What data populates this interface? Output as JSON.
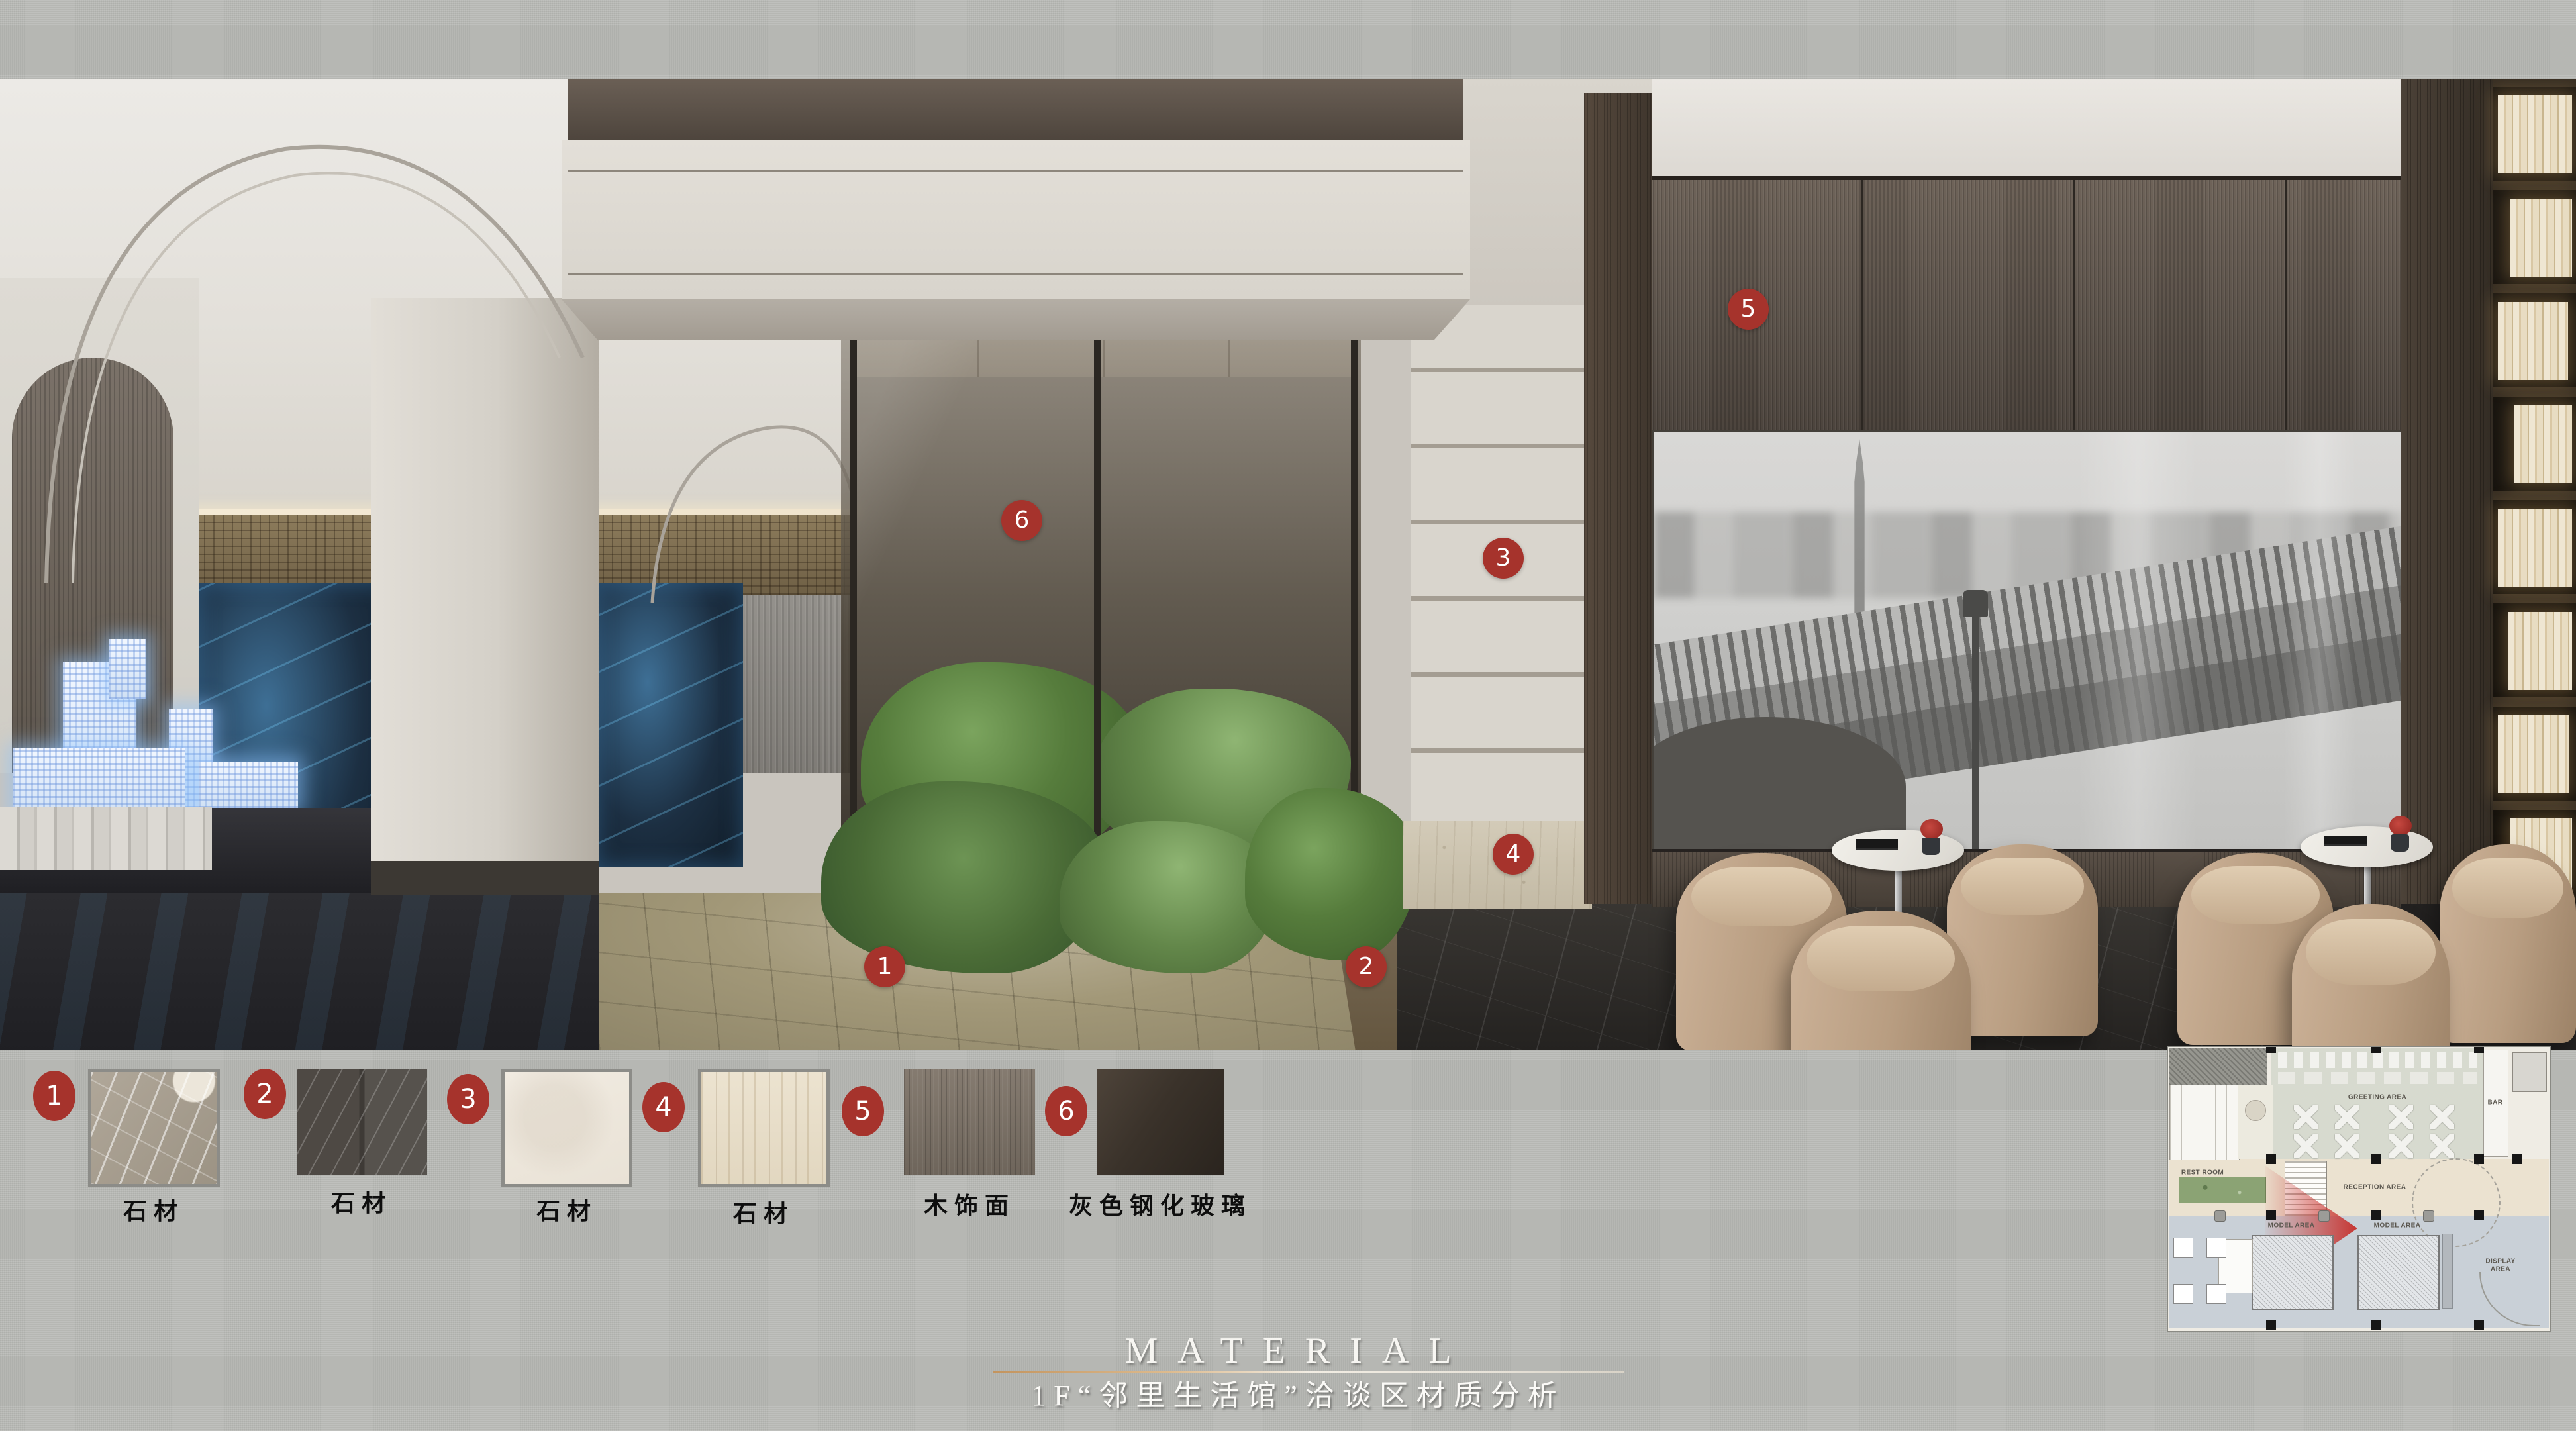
{
  "title": {
    "heading": "MATERIAL",
    "subtitle": "1F“邻里生活馆”洽谈区材质分析"
  },
  "colors": {
    "badge_red": "#a6332c",
    "accent_line_gold": "#c3945e",
    "background_fabric": "#b6b7b3"
  },
  "markers": [
    {
      "number": "1"
    },
    {
      "number": "2"
    },
    {
      "number": "3"
    },
    {
      "number": "4"
    },
    {
      "number": "5"
    },
    {
      "number": "6"
    }
  ],
  "materials": [
    {
      "number": "1",
      "label": "石材"
    },
    {
      "number": "2",
      "label": "石材"
    },
    {
      "number": "3",
      "label": "石材"
    },
    {
      "number": "4",
      "label": "石材"
    },
    {
      "number": "5",
      "label": "木饰面"
    },
    {
      "number": "6",
      "label": "灰色钢化玻璃"
    }
  ],
  "floor_plan": {
    "labels": {
      "greeting": "GREETING AREA",
      "reception": "RECEPTION AREA",
      "model_1": "MODEL AREA",
      "model_2": "MODEL AREA",
      "display": "DISPLAY AREA",
      "rest_room": "REST ROOM",
      "bar": "BAR"
    }
  }
}
